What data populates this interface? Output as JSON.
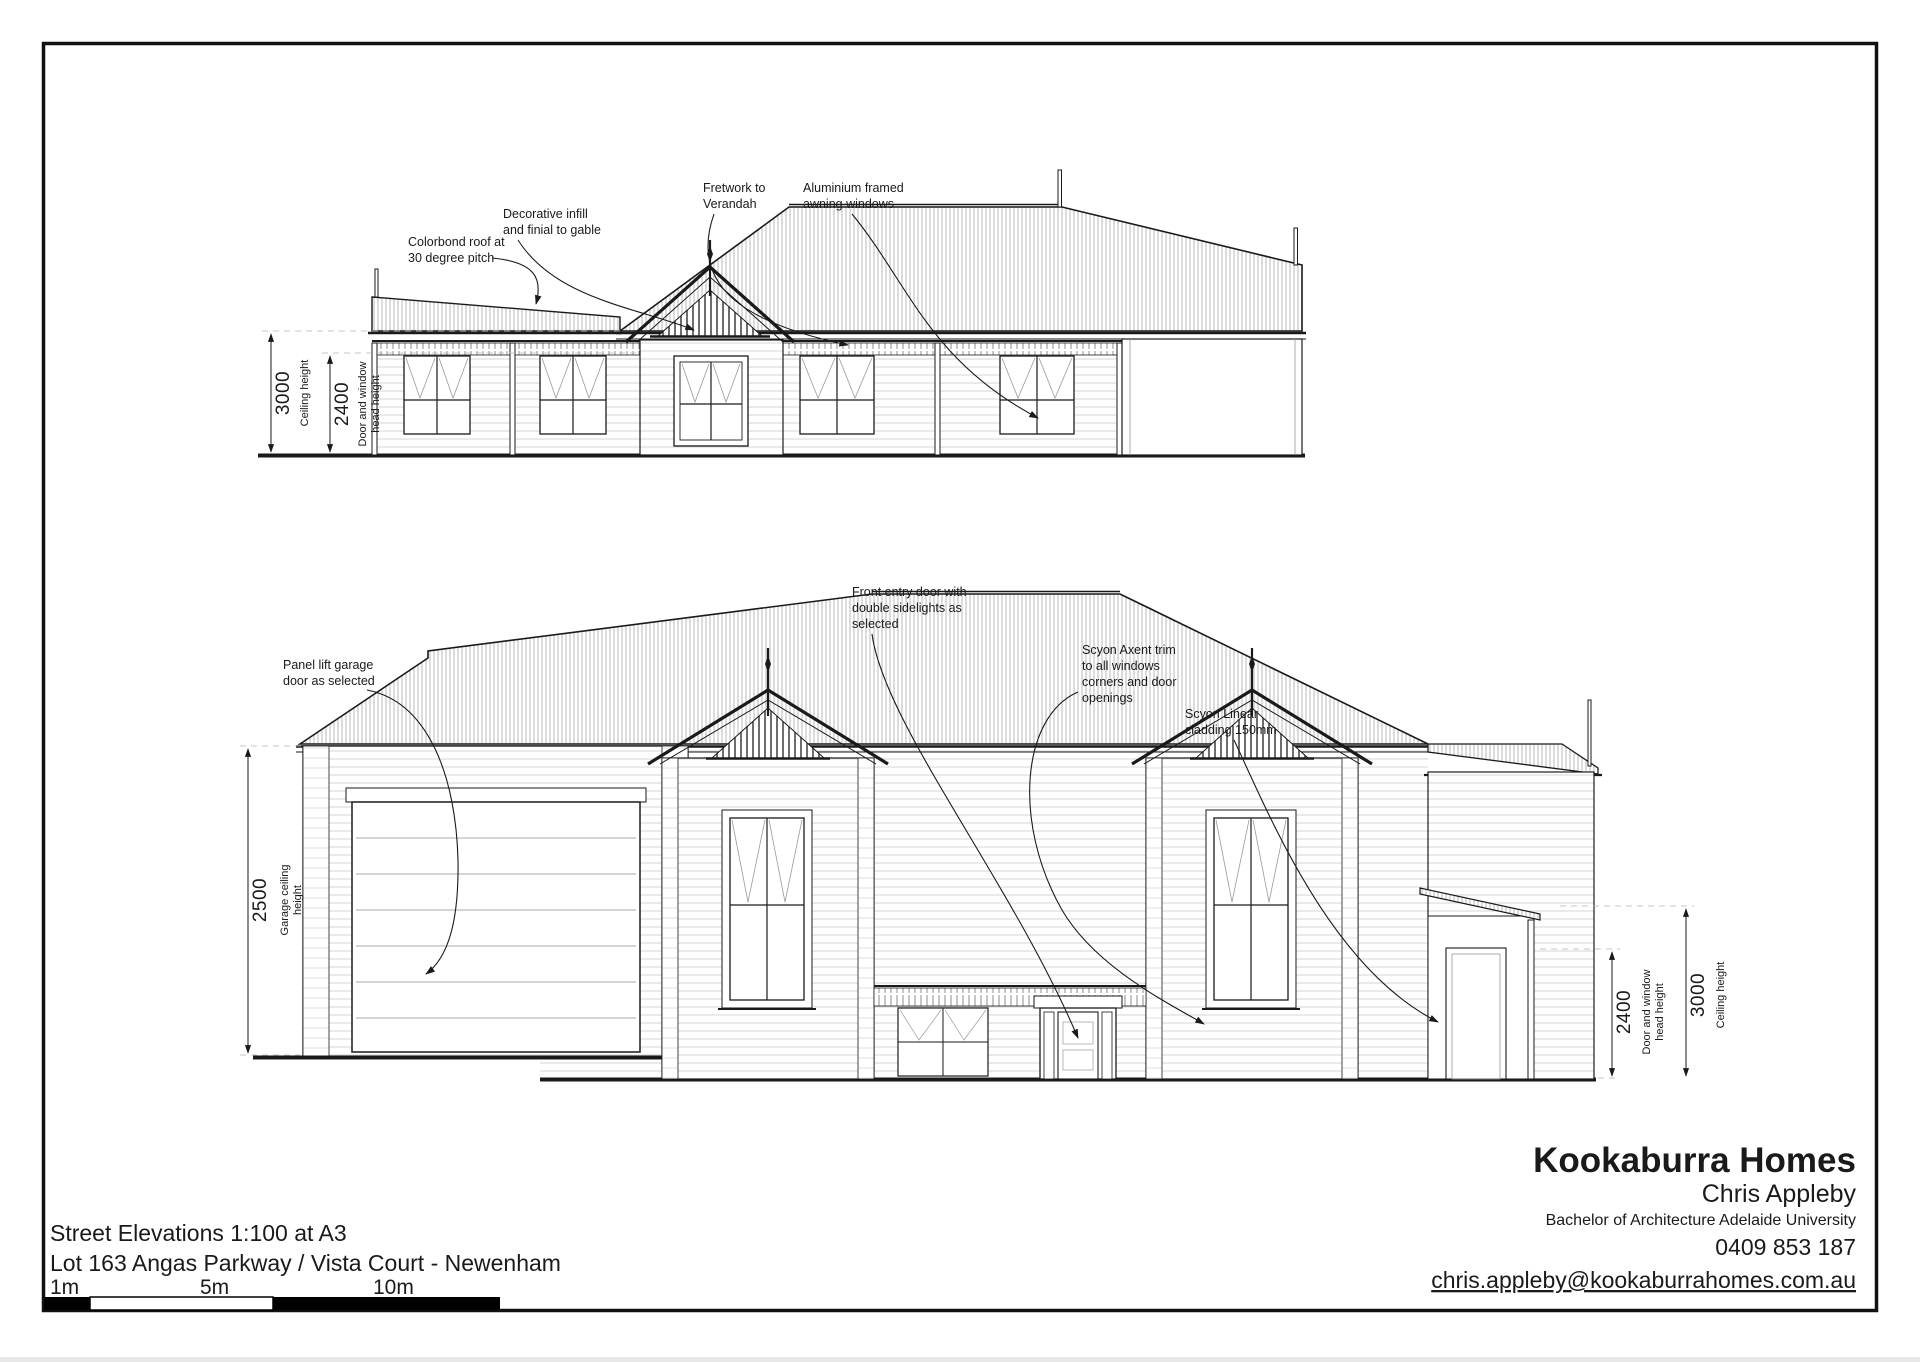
{
  "page": {
    "background": "#ffffff",
    "line_color": "#1a1a1a"
  },
  "title_block": {
    "line1": "Street Elevations 1:100 at A3",
    "line2": "Lot 163 Angas Parkway / Vista Court - Newenham",
    "scale_labels": {
      "m1": "1m",
      "m5": "5m",
      "m10": "10m"
    }
  },
  "company_block": {
    "name": "Kookaburra Homes",
    "person": "Chris Appleby",
    "credentials": "Bachelor of Architecture Adelaide University",
    "phone": "0409 853 187",
    "email": "chris.appleby@kookaburrahomes.com.au"
  },
  "top_elevation": {
    "annotations": {
      "colorbond": [
        "Colorbond roof at",
        "30 degree pitch"
      ],
      "gable": [
        "Decorative infill",
        "and finial to gable"
      ],
      "fretwork": [
        "Fretwork to",
        "Verandah"
      ],
      "windows": [
        "Aluminium framed",
        "awning windows"
      ]
    },
    "dimensions": {
      "ceiling": {
        "value": "3000",
        "label": [
          "Ceiling height"
        ]
      },
      "head": {
        "value": "2400",
        "label": [
          "Door and window",
          "head height"
        ]
      }
    }
  },
  "bottom_elevation": {
    "annotations": {
      "garage": [
        "Panel lift garage",
        "door as selected"
      ],
      "entry": [
        "Front entry door with",
        "double sidelights as",
        "selected"
      ],
      "axent": [
        "Scyon Axent trim",
        "to all windows",
        "corners and door",
        "openings"
      ],
      "cladding": [
        "Scyon Linear",
        "cladding 150mm"
      ]
    },
    "dimensions": {
      "garage_ceiling": {
        "value": "2500",
        "label": [
          "Garage ceiling",
          "height"
        ]
      },
      "head": {
        "value": "2400",
        "label": [
          "Door and window",
          "head height"
        ]
      },
      "ceiling": {
        "value": "3000",
        "label": [
          "Ceiling height"
        ]
      }
    }
  }
}
